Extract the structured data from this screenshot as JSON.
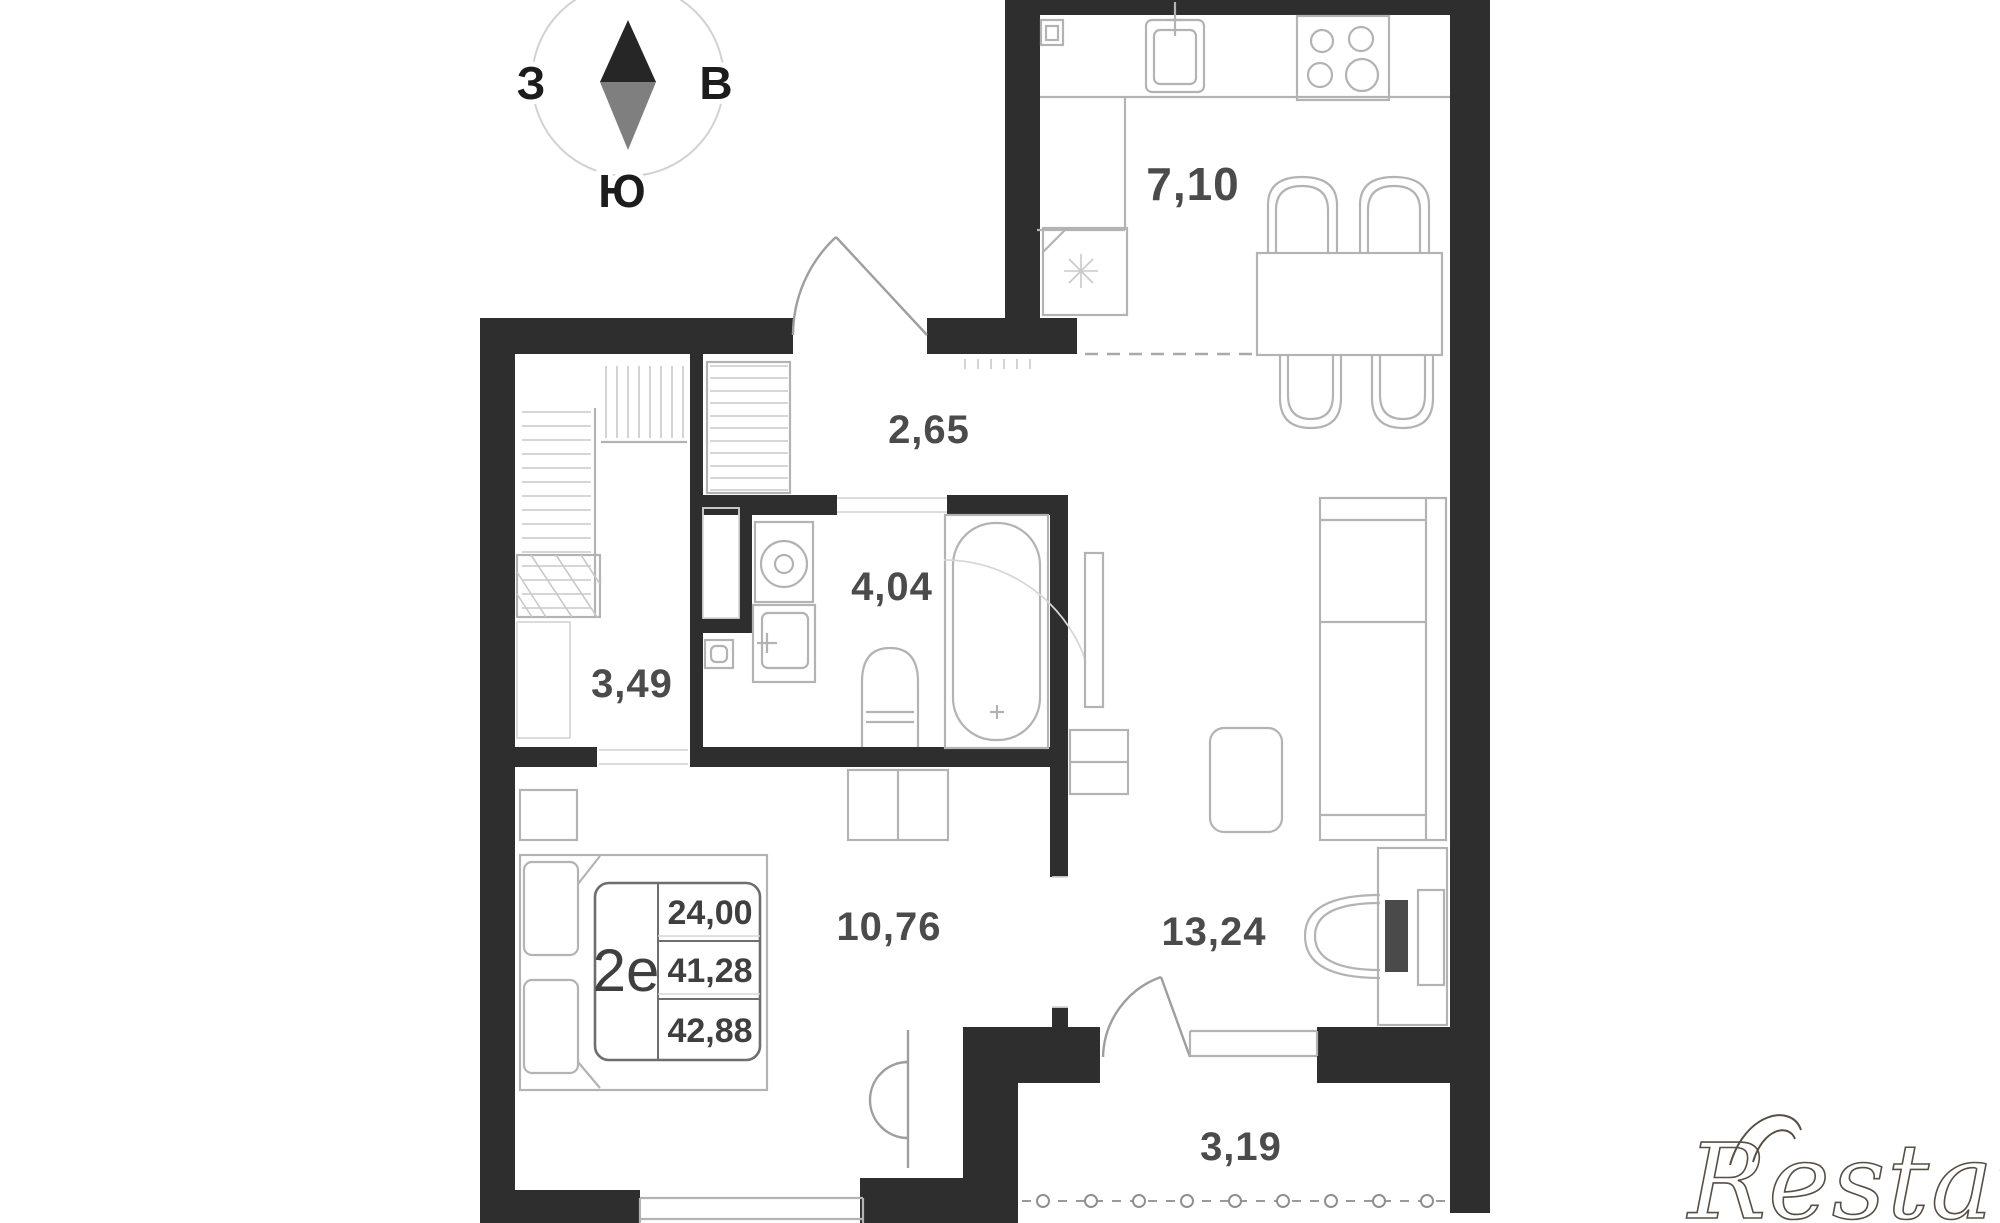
{
  "compass": {
    "west": "З",
    "east": "В",
    "south": "Ю"
  },
  "rooms": {
    "kitchen": {
      "area": "7,10"
    },
    "hallway": {
      "area": "2,65"
    },
    "bathroom": {
      "area": "4,04"
    },
    "closet": {
      "area": "3,49"
    },
    "bedroom": {
      "area": "10,76"
    },
    "living_room": {
      "area": "13,24"
    },
    "balcony": {
      "area": "3,19"
    }
  },
  "info_box": {
    "plan_type": "2е",
    "rows": [
      "24,00",
      "41,28",
      "42,88"
    ]
  },
  "watermark": {
    "text": "Restate"
  },
  "colors": {
    "wall": "#2e2e2e",
    "furniture_line": "#b3b3b3",
    "label_text": "#4b4b4b",
    "needle_top": "#262626",
    "needle_bottom": "#7f7f7f",
    "watermark": "#574e44"
  }
}
